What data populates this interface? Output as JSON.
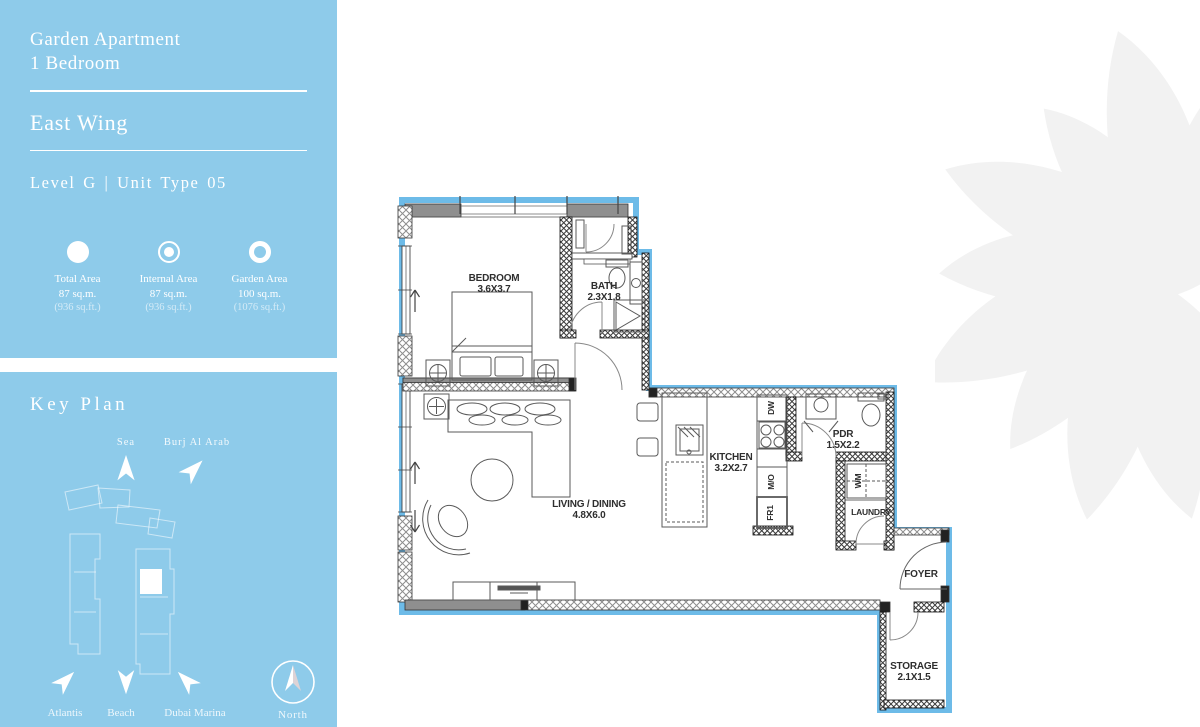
{
  "sidebar": {
    "title_line1": "Garden Apartment",
    "title_line2": "1 Bedroom",
    "wing": "East Wing",
    "level_unit": "Level G | Unit Type 05",
    "areas": [
      {
        "icon": "filled-circle-icon",
        "label": "Total Area",
        "metric": "87 sq.m.",
        "imperial": "(936 sq.ft.)"
      },
      {
        "icon": "dot-in-ring-icon",
        "label": "Internal Area",
        "metric": "87 sq.m.",
        "imperial": "(936 sq.ft.)"
      },
      {
        "icon": "ring-circle-icon",
        "label": "Garden Area",
        "metric": "100 sq.m.",
        "imperial": "(1076 sq.ft.)"
      }
    ]
  },
  "key_plan": {
    "title": "Key Plan",
    "landmarks_top": [
      {
        "label": "Sea"
      },
      {
        "label": "Burj Al Arab"
      }
    ],
    "landmarks_bottom": [
      {
        "label": "Atlantis"
      },
      {
        "label": "Beach"
      },
      {
        "label": "Dubai Marina"
      }
    ],
    "compass_label": "North"
  },
  "floor_plan": {
    "rooms": {
      "bedroom": {
        "name": "BEDROOM",
        "dims": "3.6X3.7"
      },
      "bath": {
        "name": "BATH",
        "dims": "2.3X1.8"
      },
      "living": {
        "name": "LIVING / DINING",
        "dims": "4.8X6.0"
      },
      "kitchen": {
        "name": "KITCHEN",
        "dims": "3.2X2.7"
      },
      "pdr": {
        "name": "PDR",
        "dims": "1.5X2.2"
      },
      "laundry": {
        "name": "LAUNDRY"
      },
      "foyer": {
        "name": "FOYER"
      },
      "storage": {
        "name": "STORAGE",
        "dims": "2.1X1.5"
      }
    },
    "appliances": {
      "dw": "DW",
      "mo": "M/O",
      "fr": "FR1",
      "wm": "WM"
    }
  },
  "colors": {
    "panel_blue": "#8ecbea",
    "unit_outline_blue": "#6dbbe8",
    "wall_gray": "#8f8f8f",
    "ornament_gray": "#f2f2f2"
  }
}
